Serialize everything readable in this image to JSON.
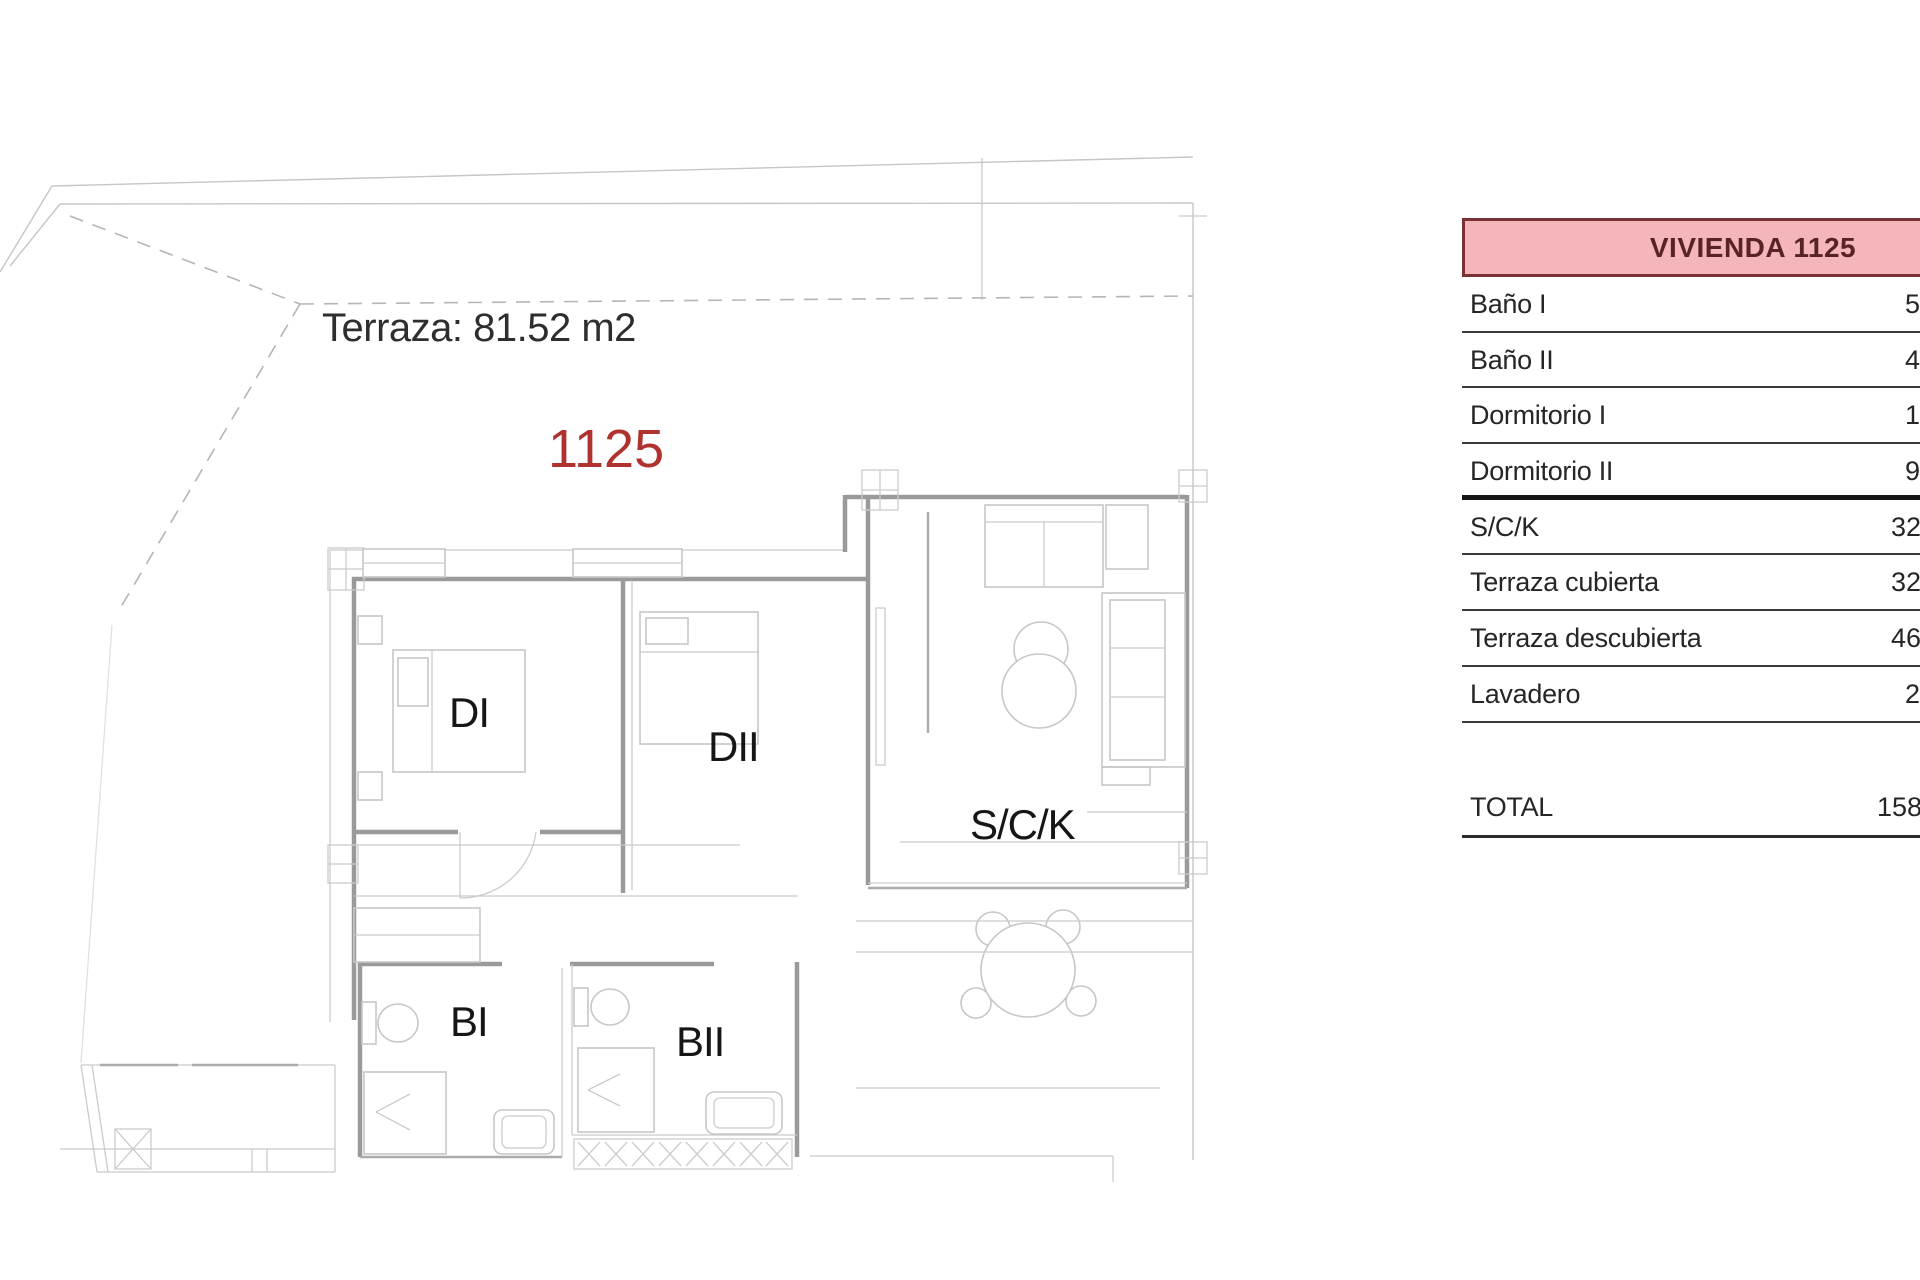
{
  "plan": {
    "terrace_label": "Terraza: 81.52 m2",
    "unit_number": "1125",
    "rooms": {
      "di": "DI",
      "dii": "DII",
      "sck": "S/C/K",
      "bi": "BI",
      "bii": "BII"
    }
  },
  "table": {
    "header": "VIVIENDA 1125",
    "rows": [
      {
        "label": "Baño I",
        "value": "5"
      },
      {
        "label": "Baño II",
        "value": "4"
      },
      {
        "label": "Dormitorio I",
        "value": "1"
      },
      {
        "label": "Dormitorio II",
        "value": "9"
      },
      {
        "label": "S/C/K",
        "value": "32"
      },
      {
        "label": "Terraza cubierta",
        "value": "32"
      },
      {
        "label": "Terraza descubierta",
        "value": "46"
      },
      {
        "label": "Lavadero",
        "value": "2"
      }
    ],
    "total": {
      "label": "TOTAL",
      "value": "158"
    }
  },
  "colors": {
    "accent_red": "#b0322f",
    "header_bg": "#f4b6ba",
    "header_border": "#7a3136",
    "header_text": "#572326"
  }
}
